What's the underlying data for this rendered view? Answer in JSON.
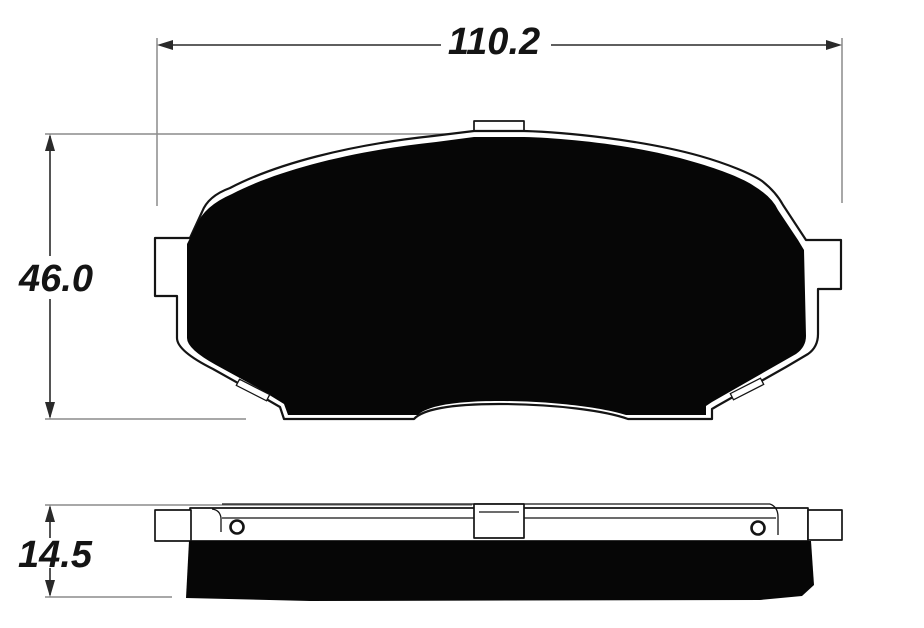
{
  "drawing": {
    "dimensions": {
      "width": {
        "label": "110.2"
      },
      "height": {
        "label": "46.0"
      },
      "thickness": {
        "label": "14.5"
      }
    },
    "colors": {
      "outline": "#141414",
      "friction_fill": "#060606",
      "dimension_line": "#2a2a2a",
      "extension_line": "#8c8c8c",
      "background": "#ffffff"
    }
  }
}
